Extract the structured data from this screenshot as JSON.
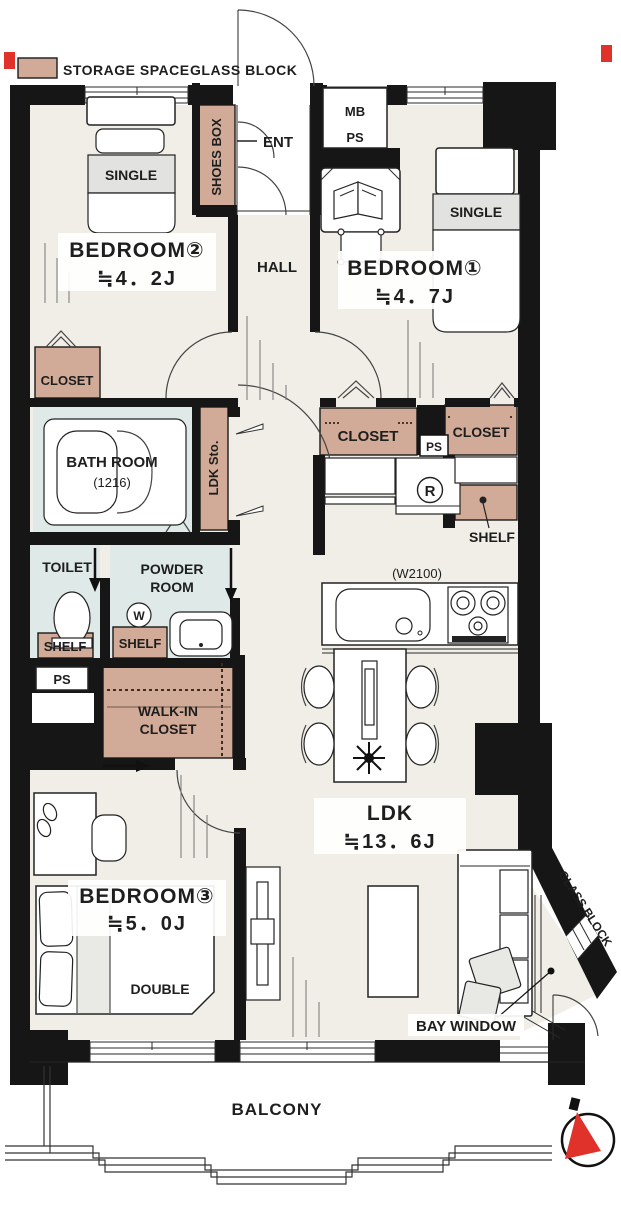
{
  "legend": {
    "storage_label": "STORAGE SPACE",
    "glass_block_label": "GLASS BLOCK"
  },
  "colors": {
    "storage": "#d1ab97",
    "wet_room": "#dfe9e8",
    "floor": "#f0eee7",
    "wall": "#161616",
    "accent_red": "#e0312a",
    "bed_band": "#e2e2e0",
    "white": "#ffffff"
  },
  "entrance": {
    "label": "ENT",
    "shoes_box": "SHOES BOX"
  },
  "utilities": {
    "mb": "MB",
    "ps": "PS"
  },
  "hall": {
    "label": "HALL"
  },
  "bedroom1": {
    "name": "BEDROOM①",
    "area": "≒4．7J",
    "bed": "SINGLE"
  },
  "bedroom2": {
    "name": "BEDROOM②",
    "area": "≒4．2J",
    "bed": "SINGLE"
  },
  "bedroom3": {
    "name": "BEDROOM③",
    "area": "≒5．0J",
    "bed": "DOUBLE"
  },
  "ldk": {
    "name": "LDK",
    "area": "≒13．6J",
    "kitchen_width": "(W2100)",
    "storage": "LDK Sto."
  },
  "bathroom": {
    "name": "BATH ROOM",
    "size": "(1216)"
  },
  "toilet": {
    "label": "TOILET"
  },
  "powder_room": {
    "line1": "POWDER",
    "line2": "ROOM",
    "washer_symbol": "W"
  },
  "walk_in_closet": {
    "line1": "WALK-IN",
    "line2": "CLOSET"
  },
  "closet_label": "CLOSET",
  "shelf_label": "SHELF",
  "refrigerator_symbol": "R",
  "bay_window": {
    "label": "BAY WINDOW",
    "glass_block": "GLASS BLOCK"
  },
  "balcony": {
    "label": "BALCONY"
  }
}
